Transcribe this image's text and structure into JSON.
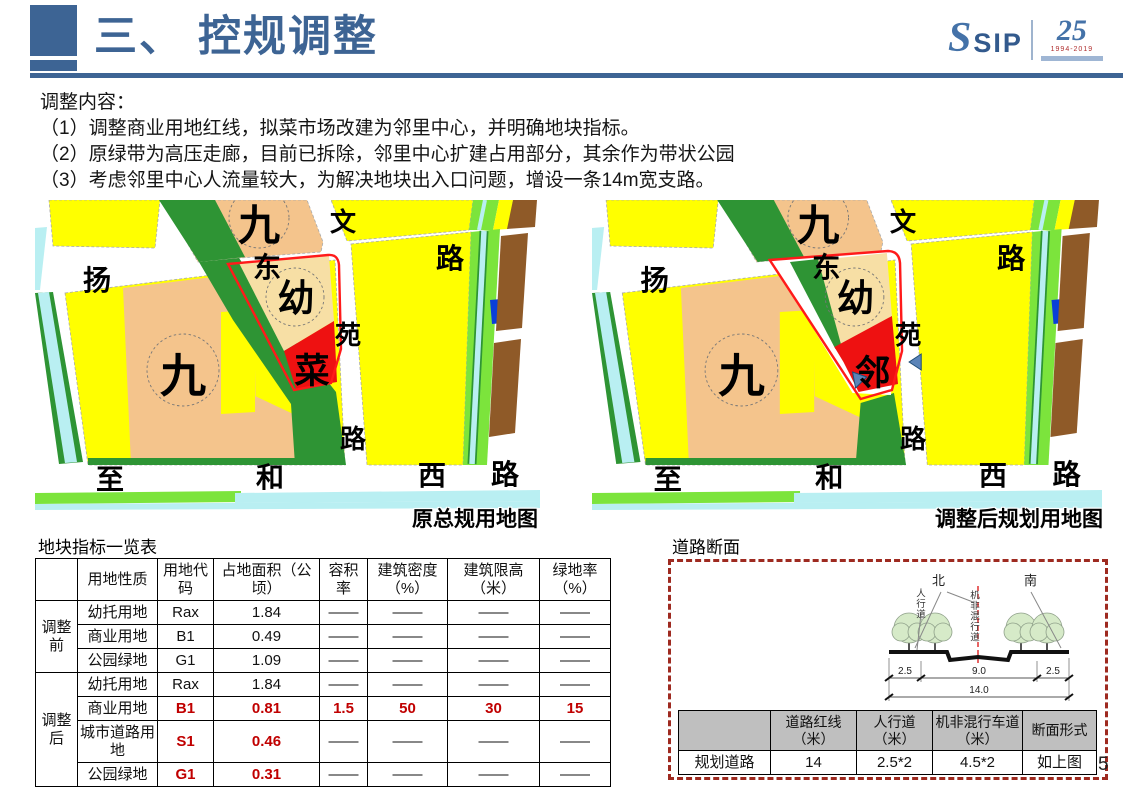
{
  "header": {
    "title": "三、 控规调整",
    "logo": {
      "s": "S",
      "sip": "SIP",
      "num": "25",
      "years": "1994-2019"
    }
  },
  "intro": {
    "heading": "调整内容：",
    "items": [
      "（1）调整商业用地红线，拟菜市场改建为邻里中心，并明确地块指标。",
      "（2）原绿带为高压走廊，目前已拆除，邻里中心扩建占用部分，其余作为带状公园",
      "（3）考虑邻里中心人流量较大，为解决地块出入口问题，增设一条14m宽支路。"
    ]
  },
  "maps": {
    "labels": {
      "jiu_top": "九",
      "jiu_main": "九",
      "you": "幼",
      "wen": "文",
      "yuan": "苑",
      "lu_v": "路",
      "yang": "扬",
      "dong": "东",
      "lu_h": "路",
      "zhi": "至",
      "he": "和",
      "xi": "西",
      "lu_b": "路"
    },
    "left": {
      "mark": "菜",
      "caption": "原总规用地图"
    },
    "right": {
      "mark": "邻",
      "caption": "调整后规划用地图"
    }
  },
  "indicator_table": {
    "title": "地块指标一览表",
    "headers": [
      "",
      "用地性质",
      "用地代码",
      "占地面积（公顷）",
      "容积率",
      "建筑密度（%）",
      "建筑限高（米）",
      "绿地率（%）"
    ],
    "groups": [
      {
        "label": "调整前",
        "rows": [
          {
            "cells": [
              "幼托用地",
              "Rax",
              "1.84",
              "——",
              "——",
              "——",
              "——"
            ]
          },
          {
            "cells": [
              "商业用地",
              "B1",
              "0.49",
              "——",
              "——",
              "——",
              "——"
            ]
          },
          {
            "cells": [
              "公园绿地",
              "G1",
              "1.09",
              "——",
              "——",
              "——",
              "——"
            ]
          }
        ]
      },
      {
        "label": "调整后",
        "rows": [
          {
            "cells": [
              "幼托用地",
              "Rax",
              "1.84",
              "——",
              "——",
              "——",
              "——"
            ]
          },
          {
            "cells": [
              "商业用地",
              "B1",
              "0.81",
              "1.5",
              "50",
              "30",
              "15"
            ]
          },
          {
            "cells": [
              "城市道路用地",
              "S1",
              "0.46",
              "——",
              "——",
              "——",
              "——"
            ]
          },
          {
            "cells": [
              "公园绿地",
              "G1",
              "0.31",
              "——",
              "——",
              "——",
              "——"
            ]
          }
        ]
      }
    ]
  },
  "road_section": {
    "title": "道路断面",
    "diagram": {
      "north": "北",
      "south": "南",
      "sidewalk_label": "人行道",
      "mixed_lane_label": "机非混行道",
      "dims": [
        "2.5",
        "9.0",
        "2.5"
      ],
      "total": "14.0"
    },
    "table": {
      "headers": [
        "",
        "道路红线（米）",
        "人行道（米）",
        "机非混行车道（米）",
        "断面形式"
      ],
      "row": [
        "规划道路",
        "14",
        "2.5*2",
        "4.5*2",
        "如上图"
      ]
    }
  },
  "page_number": "5",
  "colors": {
    "header_blue": "#3D6494",
    "table_red": "#C00000",
    "box_dashed_red": "#9E2A20",
    "map": {
      "residential_yellow": "#FFFF00",
      "school_peach": "#F4C48C",
      "kindergarten_tan": "#F7DFA5",
      "greenbelt": "#2E9434",
      "park_green": "#7CE43C",
      "water_cyan": "#B9EFF2",
      "brown": "#8F5A28",
      "market_red": "#EE1111",
      "parcel_outline": "#FF1A1A",
      "blue_parcel": "#0A3FD8"
    }
  }
}
